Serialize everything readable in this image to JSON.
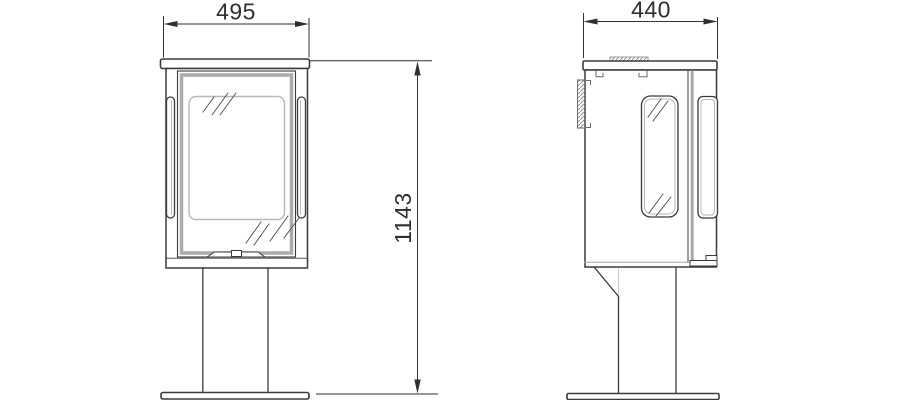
{
  "diagram": {
    "type": "technical-dimension-drawing",
    "subject": "free-standing wood stove, front and side elevation views",
    "dimensions": {
      "front_width": "495",
      "depth": "440",
      "height": "1143"
    },
    "colors": {
      "line": "#3a3a3a",
      "light_line": "#b8b8b8",
      "frame_gray": "#ababab",
      "text": "#2f2f2f",
      "background": "#ffffff"
    }
  }
}
